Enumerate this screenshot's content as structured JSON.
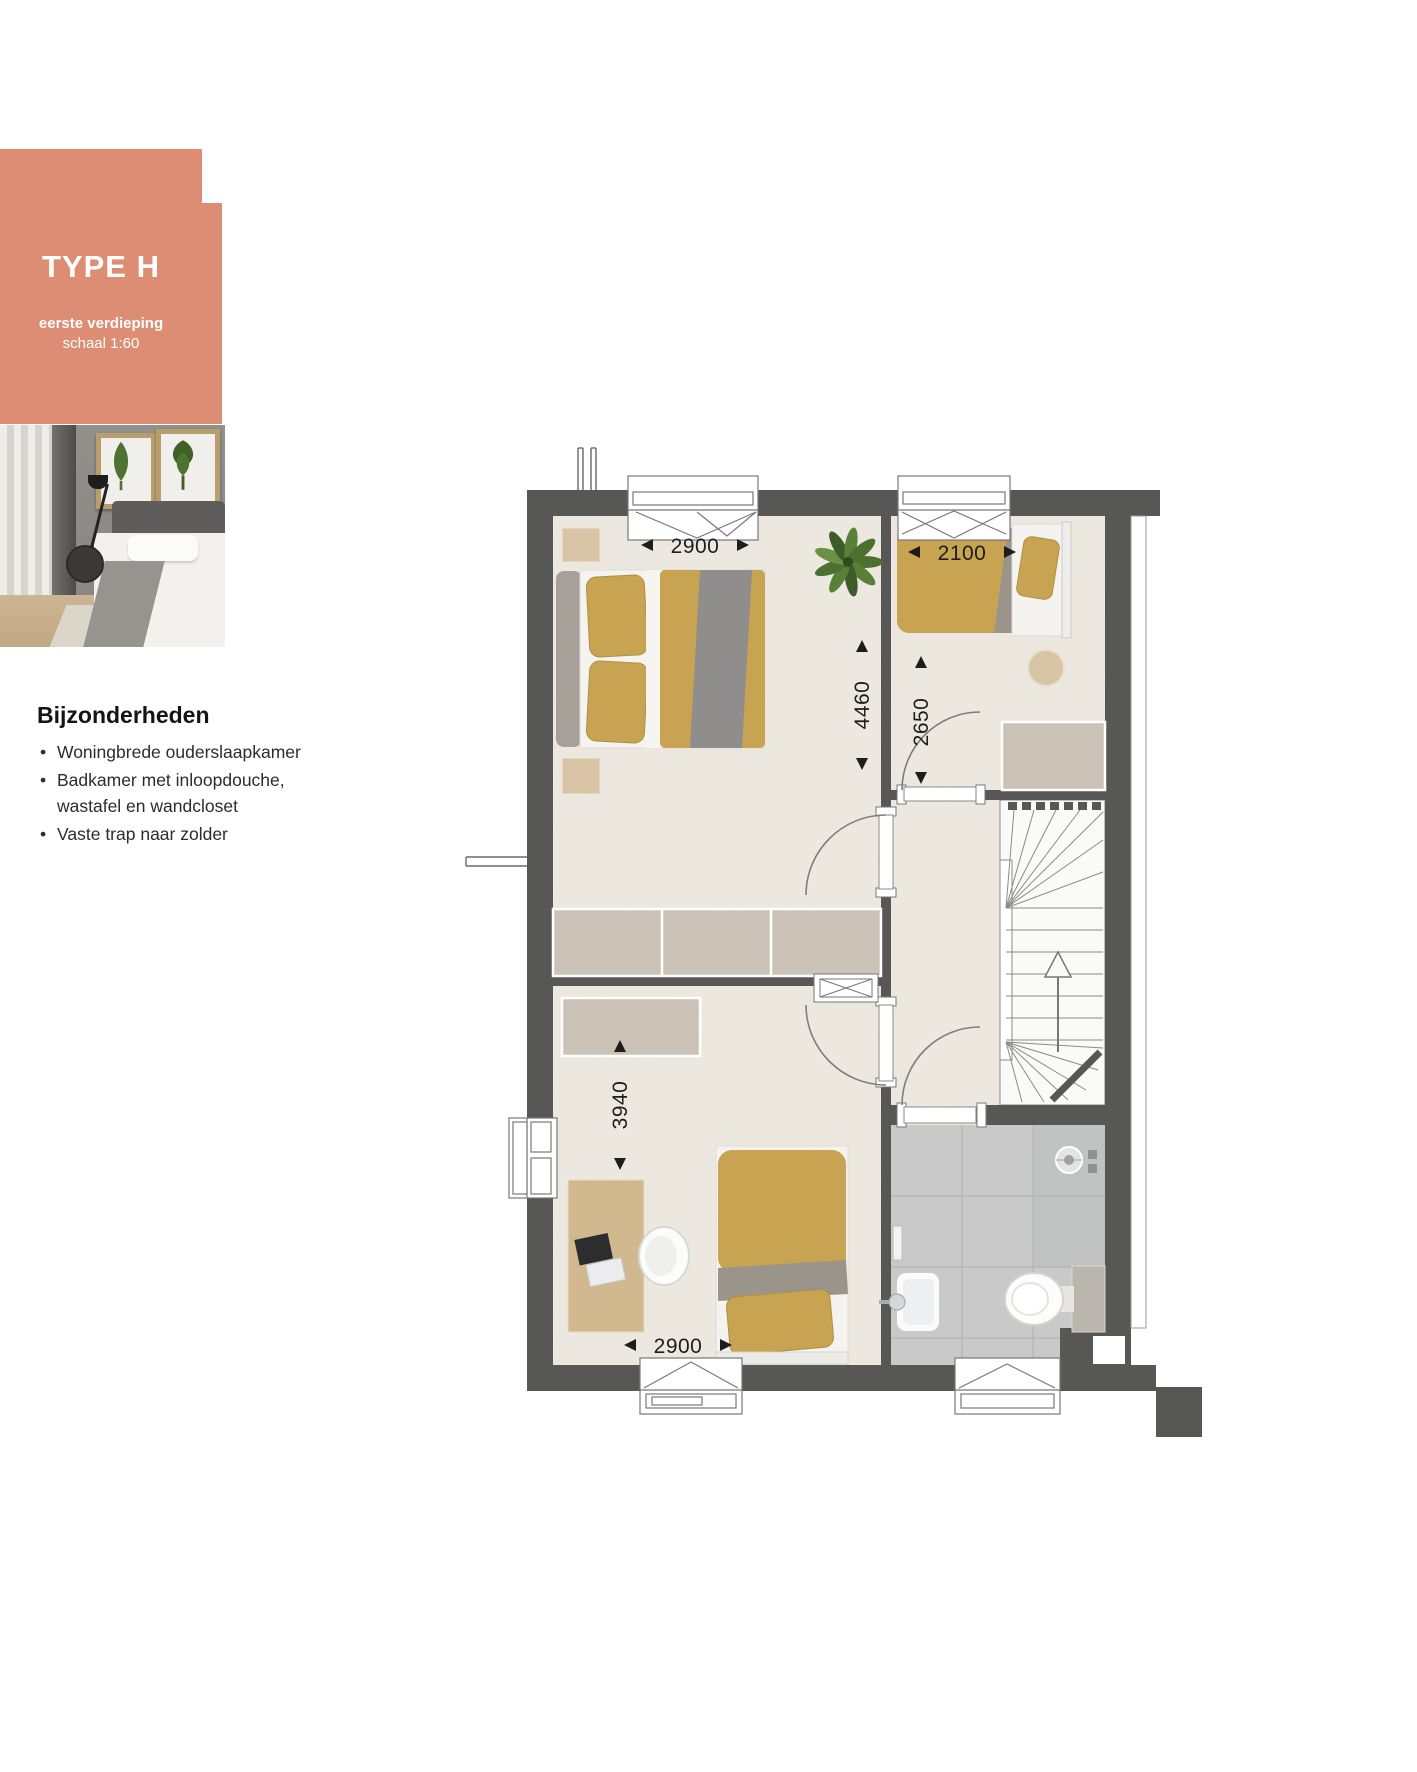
{
  "badge": {
    "title": "TYPE H",
    "subtitle_line1": "eerste verdieping",
    "subtitle_line2": "schaal 1:60",
    "background_color": "#DC8D74",
    "text_color": "#FFFFFF"
  },
  "photo": {
    "label": "bedroom-photo"
  },
  "details": {
    "heading": "Bijzonderheden",
    "bullets": [
      "Woningbrede ouderslaapkamer",
      "Badkamer met inloopdouche, wastafel en wandcloset",
      "Vaste trap naar zolder"
    ]
  },
  "plan": {
    "colors": {
      "wall": "#575756",
      "floor": "#EFEBE3",
      "tile": "#C8C9C8",
      "tile_shower": "#C1C3C2",
      "accent_bed": "#C8A351",
      "closet": "#CAC2B6",
      "wood": "#D2B88F"
    },
    "dimensions": {
      "master_width": {
        "value": "2900",
        "orientation": "horizontal"
      },
      "bedroom2_width": {
        "value": "2100",
        "orientation": "horizontal"
      },
      "master_depth": {
        "value": "4460",
        "orientation": "vertical"
      },
      "bedroom2_depth": {
        "value": "2650",
        "orientation": "vertical"
      },
      "bedroom3_depth": {
        "value": "3940",
        "orientation": "vertical"
      },
      "bedroom3_width": {
        "value": "2900",
        "orientation": "horizontal"
      }
    },
    "icons": {
      "plant": "potted-plant-top-view",
      "stairs": "winder-staircase-up-arrow",
      "shower": "shower-drain",
      "sink": "washbasin",
      "toilet": "wall-closet",
      "bed_double": "double-bed",
      "bed_single": "single-bed",
      "desk": "desk-with-laptop"
    }
  }
}
